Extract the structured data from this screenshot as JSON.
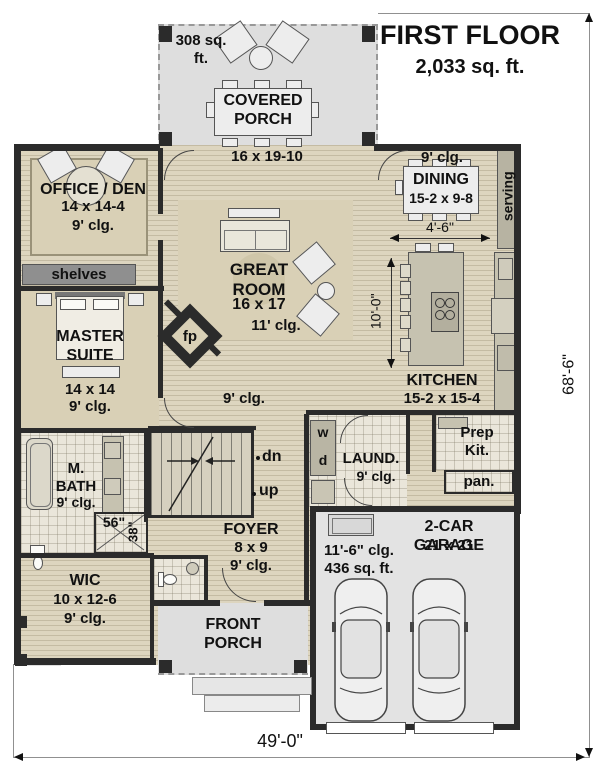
{
  "title": {
    "name": "FIRST FLOOR",
    "area": "2,033 sq. ft."
  },
  "overall_dims": {
    "width": "49'-0\"",
    "height": "68'-6\""
  },
  "covered_porch": {
    "area": "308 sq. ft.",
    "name": "COVERED PORCH",
    "dims": "16 x 19-10"
  },
  "office": {
    "name": "OFFICE / DEN",
    "dims": "14 x 14-4",
    "ceiling": "9' clg."
  },
  "shelves": "shelves",
  "dining": {
    "ceiling": "9' clg.",
    "name": "DINING",
    "dims": "15-2 x 9-8",
    "serving": "serving",
    "dim_4_6": "4'-6\""
  },
  "great_room": {
    "name": "GREAT ROOM",
    "dims": "16 x 17",
    "ceiling": "11' clg."
  },
  "master": {
    "name": "MASTER SUITE",
    "dims": "14 x 14",
    "ceiling": "9' clg."
  },
  "fireplace": "fp",
  "hall_ceiling": "9' clg.",
  "kitchen": {
    "name": "KITCHEN",
    "dims": "15-2 x 15-4",
    "island_dim": "10'-0\""
  },
  "mbath": {
    "name": "M. BATH",
    "ceiling": "9' clg."
  },
  "shower": {
    "w": "56\"",
    "d": "38\""
  },
  "laundry": {
    "name": "LAUND.",
    "ceiling": "9' clg.",
    "washer": "w",
    "dryer": "d"
  },
  "prep_kitchen": "Prep Kit.",
  "pantry": "pan.",
  "stairs": {
    "down": "dn",
    "up": "up"
  },
  "foyer": {
    "name": "FOYER",
    "dims": "8 x 9",
    "ceiling": "9' clg."
  },
  "garage": {
    "name": "2-CAR GARAGE",
    "dims": "21 x 21",
    "ceiling": "11'-6\" clg.",
    "area": "436 sq. ft."
  },
  "wic": {
    "name": "WIC",
    "dims": "10 x 12-6",
    "ceiling": "9' clg."
  },
  "front_porch": "FRONT PORCH"
}
